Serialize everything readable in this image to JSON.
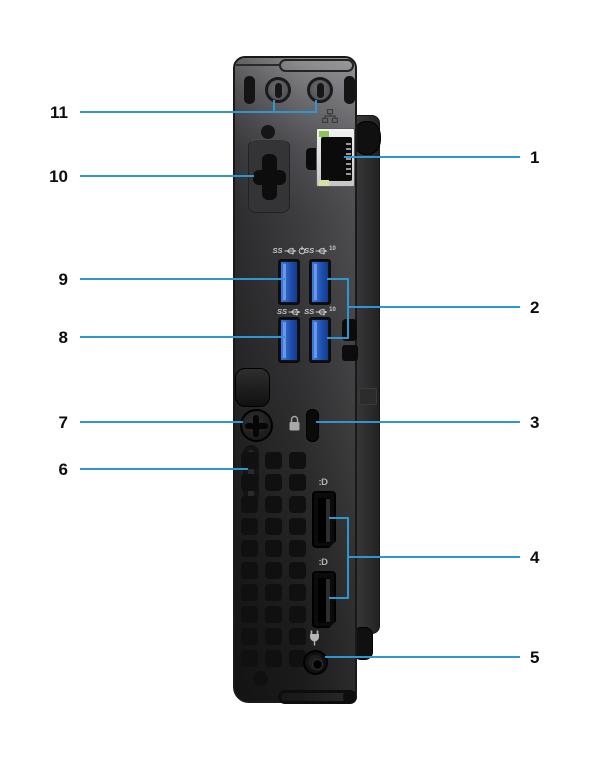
{
  "colors": {
    "callout_line": "#3096d0",
    "silkscreen": "#c8c8c8",
    "usb_blue": "#2a62c8",
    "label_text": "#0d0d0d"
  },
  "callouts": {
    "left": [
      {
        "number": "11",
        "target": "antenna-modules"
      },
      {
        "number": "10",
        "target": "optional-port"
      },
      {
        "number": "9",
        "target": "usb-port-smart-power"
      },
      {
        "number": "8",
        "target": "usb-port"
      },
      {
        "number": "7",
        "target": "thumbscrew"
      },
      {
        "number": "6",
        "target": "padlock-ring"
      }
    ],
    "right": [
      {
        "number": "1",
        "target": "ethernet-port"
      },
      {
        "number": "2",
        "target": "usb-10gbps-ports"
      },
      {
        "number": "3",
        "target": "security-cable-slot"
      },
      {
        "number": "4",
        "target": "displayports"
      },
      {
        "number": "5",
        "target": "power-connector"
      }
    ]
  },
  "ports": {
    "usb": [
      {
        "badge": "SS",
        "suffix": "power"
      },
      {
        "badge": "SS",
        "suffix": "10",
        "suffix_text": "10"
      },
      {
        "badge": "SS",
        "suffix": "none"
      },
      {
        "badge": "SS",
        "suffix": "10",
        "suffix_text": "10"
      }
    ],
    "displayport_label": ":D"
  },
  "vent_grid": {
    "columns": 3,
    "rows": 10
  }
}
